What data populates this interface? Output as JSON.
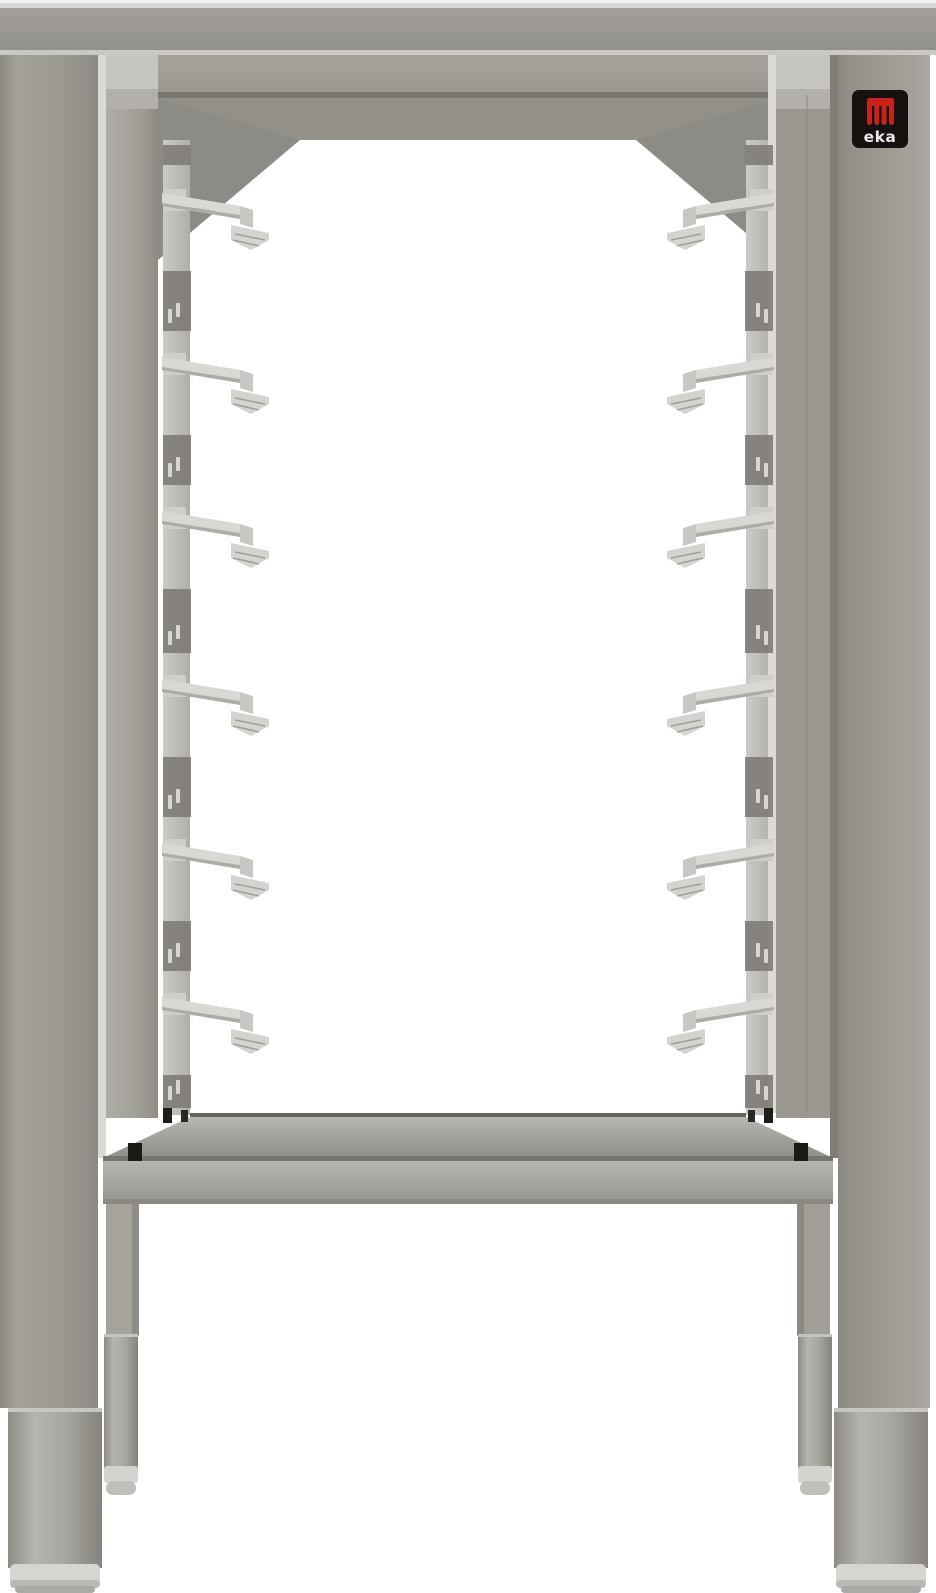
{
  "meta": {
    "type": "product-photo",
    "alt": "Stainless steel open base stand for a countertop oven with six pairs of tray support runners, a solid bottom shelf and four height-adjustable cylindrical feet, photographed on a white background"
  },
  "brand": {
    "name": "eka",
    "logo_text": "eka"
  },
  "logo": {
    "badge_bg": "#141110",
    "mark_color": "#c7231b",
    "text_color": "#eceae8"
  },
  "structure": {
    "tray_levels_per_side": 6,
    "sides": [
      "left",
      "right"
    ],
    "bracket_rows_y": [
      193,
      357,
      511,
      679,
      843,
      997
    ],
    "rail_pins_per_gap": 2,
    "has_bottom_shelf": true,
    "adjustable_feet": 4
  },
  "palette": {
    "background": "#ffffff",
    "steel_highlight": "#d8d7d4",
    "steel_light": "#c8c7c3",
    "steel_mid": "#9c9993",
    "steel_dark": "#817e78",
    "shadow_line": "#77756f",
    "clip_black": "#201e1b"
  }
}
